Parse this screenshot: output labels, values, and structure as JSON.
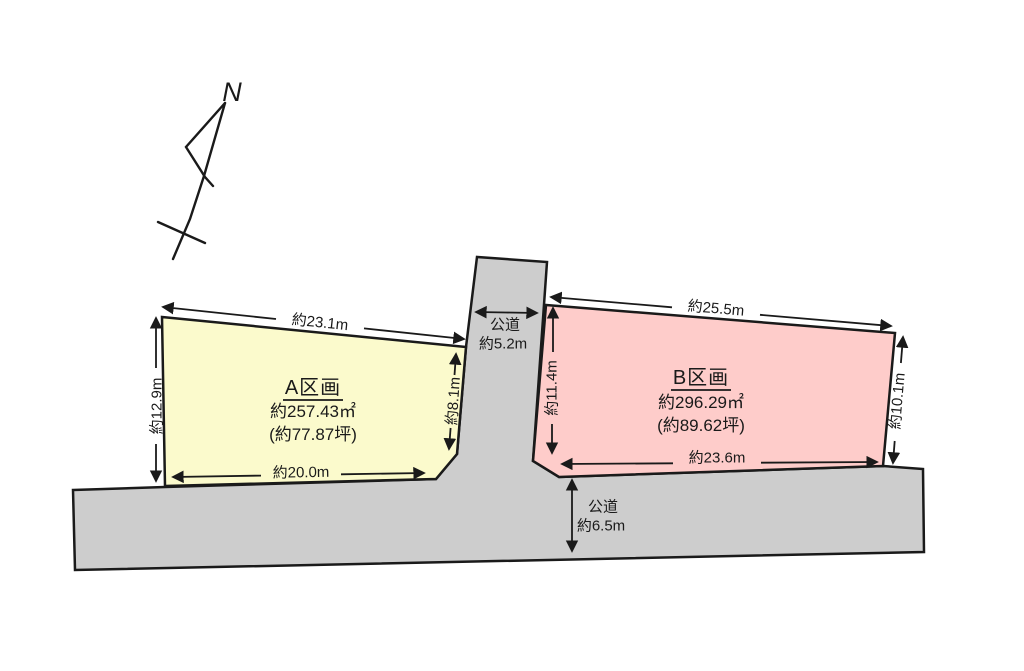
{
  "diagram": {
    "compass": {
      "label": "N"
    },
    "parcel_a": {
      "name": "A区画",
      "area_m2": "約257.43㎡",
      "area_tsubo": "(約77.87坪)",
      "dim_top": "約23.1m",
      "dim_left": "約12.9m",
      "dim_right": "約8.1m",
      "dim_bottom": "約20.0m"
    },
    "parcel_b": {
      "name": "B区画",
      "area_m2": "約296.29㎡",
      "area_tsubo": "(約89.62坪)",
      "dim_top": "約25.5m",
      "dim_left": "約11.4m",
      "dim_right": "約10.1m",
      "dim_bottom": "約23.6m"
    },
    "road_vertical": {
      "name": "公道",
      "width": "約5.2m"
    },
    "road_bottom": {
      "name": "公道",
      "width": "約6.5m"
    },
    "colors": {
      "parcel_a_fill": "#fbfacc",
      "parcel_b_fill": "#feccca",
      "road_fill": "#cdcdcd",
      "outline": "#1a1a1a"
    }
  }
}
